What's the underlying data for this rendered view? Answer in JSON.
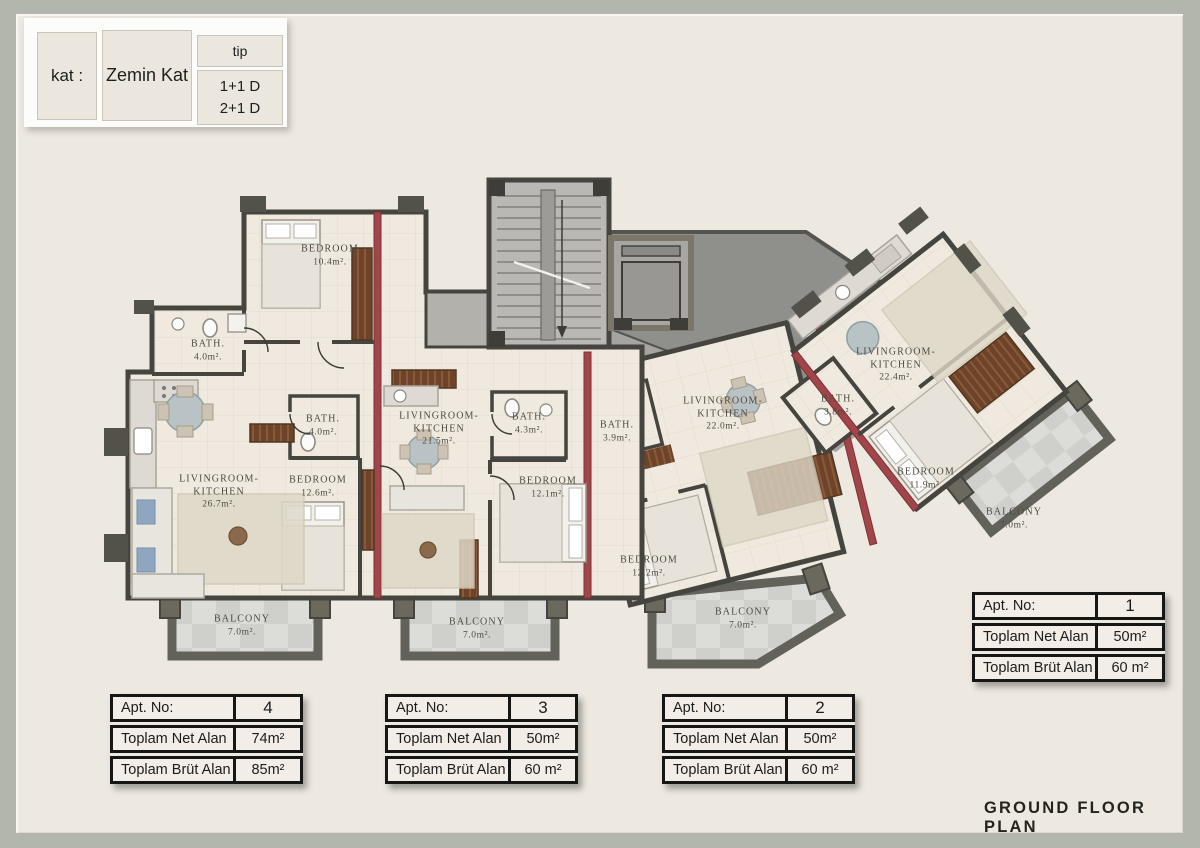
{
  "legend": {
    "kat_label": "kat :",
    "kat_value": "Zemin Kat",
    "tip_label": "tip",
    "tip_values": [
      "1+1 D",
      "2+1 D"
    ]
  },
  "title": "GROUND FLOOR PLAN",
  "rooms": [
    {
      "id": "bedroom-apt4",
      "lines": [
        "BEDROOM",
        "10.4m²."
      ],
      "x": 330,
      "y": 256
    },
    {
      "id": "bath-apt4",
      "lines": [
        "BATH.",
        "4.0m²."
      ],
      "x": 208,
      "y": 351
    },
    {
      "id": "livingroom-kitchen-apt4",
      "lines": [
        "LIVINGROOM-",
        "KITCHEN",
        "26.7m²."
      ],
      "x": 219,
      "y": 492
    },
    {
      "id": "bath-apt3",
      "lines": [
        "BATH.",
        "4.0m²."
      ],
      "x": 323,
      "y": 426
    },
    {
      "id": "bedroom-apt3",
      "lines": [
        "BEDROOM",
        "12.6m²."
      ],
      "x": 318,
      "y": 487
    },
    {
      "id": "livingroom-kitchen-apt3",
      "lines": [
        "LIVINGROOM-",
        "KITCHEN",
        "21.5m²."
      ],
      "x": 439,
      "y": 429
    },
    {
      "id": "bath-mid",
      "lines": [
        "BATH.",
        "4.3m²."
      ],
      "x": 529,
      "y": 424
    },
    {
      "id": "bedroom-mid",
      "lines": [
        "BEDROOM",
        "12.1m²."
      ],
      "x": 548,
      "y": 488
    },
    {
      "id": "bath-apt2",
      "lines": [
        "BATH.",
        "3.9m²."
      ],
      "x": 617,
      "y": 432
    },
    {
      "id": "bedroom-apt2",
      "lines": [
        "BEDROOM",
        "12.2m²."
      ],
      "x": 649,
      "y": 567
    },
    {
      "id": "livingroom-kitchen-apt2",
      "lines": [
        "LIVINGROOM-",
        "KITCHEN",
        "22.0m²."
      ],
      "x": 723,
      "y": 414
    },
    {
      "id": "bath-apt1",
      "lines": [
        "BATH.",
        "3.8m²."
      ],
      "x": 838,
      "y": 406
    },
    {
      "id": "livingroom-kitchen-apt1",
      "lines": [
        "LIVINGROOM-",
        "KITCHEN",
        "22.4m²."
      ],
      "x": 896,
      "y": 365
    },
    {
      "id": "bedroom-apt1",
      "lines": [
        "BEDROOM",
        "11.9m²."
      ],
      "x": 926,
      "y": 479
    },
    {
      "id": "balcony-apt4",
      "lines": [
        "BALCONY",
        "7.0m²."
      ],
      "x": 242,
      "y": 626
    },
    {
      "id": "balcony-apt3",
      "lines": [
        "BALCONY",
        "7.0m²."
      ],
      "x": 477,
      "y": 629
    },
    {
      "id": "balcony-apt2",
      "lines": [
        "BALCONY",
        "7.0m²."
      ],
      "x": 743,
      "y": 619
    },
    {
      "id": "balcony-apt1",
      "lines": [
        "BALCONY",
        "7.0m²."
      ],
      "x": 1014,
      "y": 519
    }
  ],
  "tables": [
    {
      "apt": "4",
      "x": 110,
      "y": 694,
      "rows": [
        [
          "Apt. No:",
          "4"
        ],
        [
          "Toplam Net Alan",
          "74m²"
        ],
        [
          "Toplam Brüt Alan",
          "85m²"
        ]
      ]
    },
    {
      "apt": "3",
      "x": 385,
      "y": 694,
      "rows": [
        [
          "Apt. No:",
          "3"
        ],
        [
          "Toplam Net Alan",
          "50m²"
        ],
        [
          "Toplam Brüt Alan",
          "60 m²"
        ]
      ]
    },
    {
      "apt": "2",
      "x": 662,
      "y": 694,
      "rows": [
        [
          "Apt. No:",
          "2"
        ],
        [
          "Toplam Net Alan",
          "50m²"
        ],
        [
          "Toplam Brüt Alan",
          "60 m²"
        ]
      ]
    },
    {
      "apt": "1",
      "x": 972,
      "y": 592,
      "rows": [
        [
          "Apt. No:",
          "1"
        ],
        [
          "Toplam Net Alan",
          "50m²"
        ],
        [
          "Toplam Brüt Alan",
          "60 m²"
        ]
      ]
    }
  ],
  "colors": {
    "page_background": "#b2b6ac",
    "panel": "#ede8e0",
    "wall": "#45443e",
    "red_wall": "#a0464a",
    "floor": "#efe9df",
    "corridor_dark": "#8f8f8c",
    "balcony_floor": "#d8d8d5"
  }
}
